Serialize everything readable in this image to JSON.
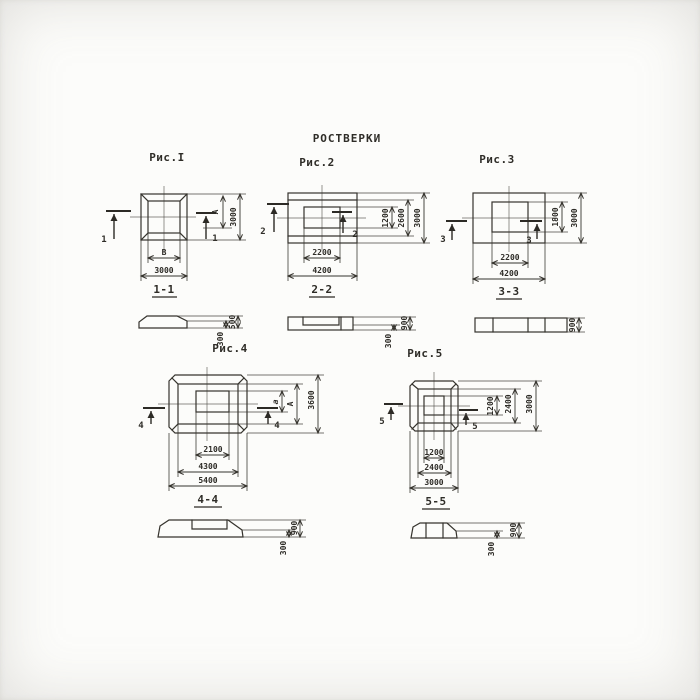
{
  "title": "РОСТВЕРКИ",
  "figures": [
    {
      "caption": "Рис.I",
      "cut": "1",
      "dims_right": [
        "A",
        "3000"
      ],
      "dims_bottom": [
        "B",
        "3000"
      ]
    },
    {
      "caption": "Рис.2",
      "cut": "2",
      "dims_right": [
        "1200",
        "2600",
        "3000"
      ],
      "dims_bottom": [
        "2200",
        "4200"
      ]
    },
    {
      "caption": "Рис.3",
      "cut": "3",
      "dims_right": [
        "1800",
        "3000"
      ],
      "dims_bottom": [
        "2200",
        "4200"
      ]
    },
    {
      "caption": "Рис.4",
      "cut": "4",
      "dims_right": [
        "a",
        "A",
        "3600"
      ],
      "dims_bottom": [
        "2100",
        "4300",
        "5400"
      ]
    },
    {
      "caption": "Рис.5",
      "cut": "5",
      "dims_right": [
        "1200",
        "2400",
        "3000"
      ],
      "dims_bottom": [
        "1200",
        "2400",
        "3000"
      ]
    }
  ],
  "sections": [
    {
      "label": "1-1",
      "dims": [
        "300",
        "500"
      ]
    },
    {
      "label": "2-2",
      "dims": [
        "300",
        "900"
      ]
    },
    {
      "label": "3-3",
      "dims": [
        "900"
      ]
    },
    {
      "label": "4-4",
      "dims": [
        "300",
        "900"
      ]
    },
    {
      "label": "5-5",
      "dims": [
        "300",
        "900"
      ]
    }
  ],
  "colors": {
    "ink": "#35332d",
    "paper": "#fcfcfa"
  }
}
